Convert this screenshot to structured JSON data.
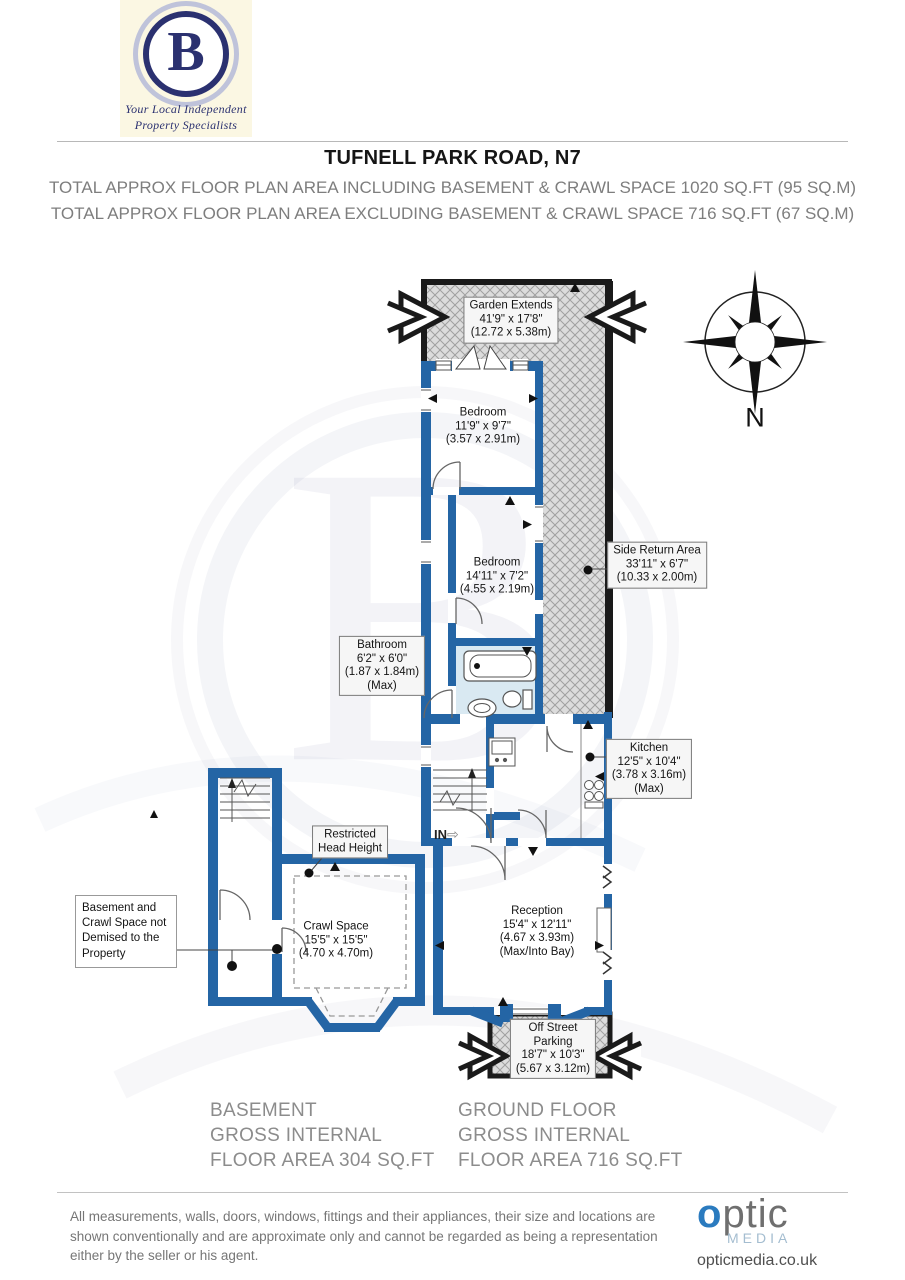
{
  "colors": {
    "wall_blue": "#2465a5",
    "outline_black": "#1a1a1a",
    "hatch_bg": "#dcdcdc",
    "hatch_line": "#a0a0a0",
    "bathroom_floor": "#d9e9f2",
    "brand_navy": "#2b3170",
    "brand_blue": "#2b7bbf",
    "muted_text": "#7e7e7e"
  },
  "header": {
    "agency_logo": {
      "letter": "B",
      "tagline_line1": "Your Local Independent",
      "tagline_line2": "Property Specialists"
    },
    "title": "TUFNELL PARK ROAD, N7",
    "total_including": "TOTAL APPROX FLOOR PLAN AREA INCLUDING BASEMENT & CRAWL SPACE 1020 SQ.FT (95 SQ.M)",
    "total_excluding": "TOTAL APPROX FLOOR PLAN AREA EXCLUDING BASEMENT & CRAWL SPACE 716 SQ.FT (67 SQ.M)"
  },
  "compass": {
    "north": "N"
  },
  "plan": {
    "entrance_label": "IN",
    "icons": {
      "entrance_arrow": "⇨"
    },
    "rooms": {
      "garden": "Garden Extends\n41'9\" x 17'8\"\n(12.72 x 5.38m)",
      "bedroom_rear": "Bedroom\n11'9\" x 9'7\"\n(3.57 x 2.91m)",
      "bedroom_middle": "Bedroom\n14'11\" x 7'2\"\n(4.55 x 2.19m)",
      "side_return": "Side Return Area\n33'11\" x 6'7\"\n(10.33 x 2.00m)",
      "bathroom": "Bathroom\n6'2\" x 6'0\"\n(1.87 x 1.84m)\n(Max)",
      "kitchen": "Kitchen\n12'5\" x 10'4\"\n(3.78 x 3.16m)\n(Max)",
      "reception": "Reception\n15'4\" x 12'11\"\n(4.67 x 3.93m)\n(Max/Into Bay)",
      "off_street_parking": "Off Street\nParking\n18'7\" x 10'3\"\n(5.67 x 3.12m)",
      "crawl_space": "Crawl Space\n15'5\" x 15'5\"\n(4.70 x 4.70m)",
      "restricted_head_height": "Restricted\nHead Height",
      "basement_note": "Basement and\nCrawl Space not\nDemised to the\nProperty"
    }
  },
  "summaries": {
    "basement": "BASEMENT\nGROSS INTERNAL\nFLOOR AREA 304 SQ.FT",
    "ground_floor": "GROUND FLOOR\nGROSS INTERNAL\nFLOOR AREA 716 SQ.FT"
  },
  "footer": {
    "disclaimer": "All measurements, walls, doors, windows, fittings and their appliances, their size and locations are shown conventionally and are approximate only and cannot be regarded as being a representation either by the seller or his agent.",
    "brand": {
      "optic_o": "o",
      "optic_rest": "ptic",
      "media": "MEDIA",
      "website": "opticmedia.co.uk"
    }
  }
}
